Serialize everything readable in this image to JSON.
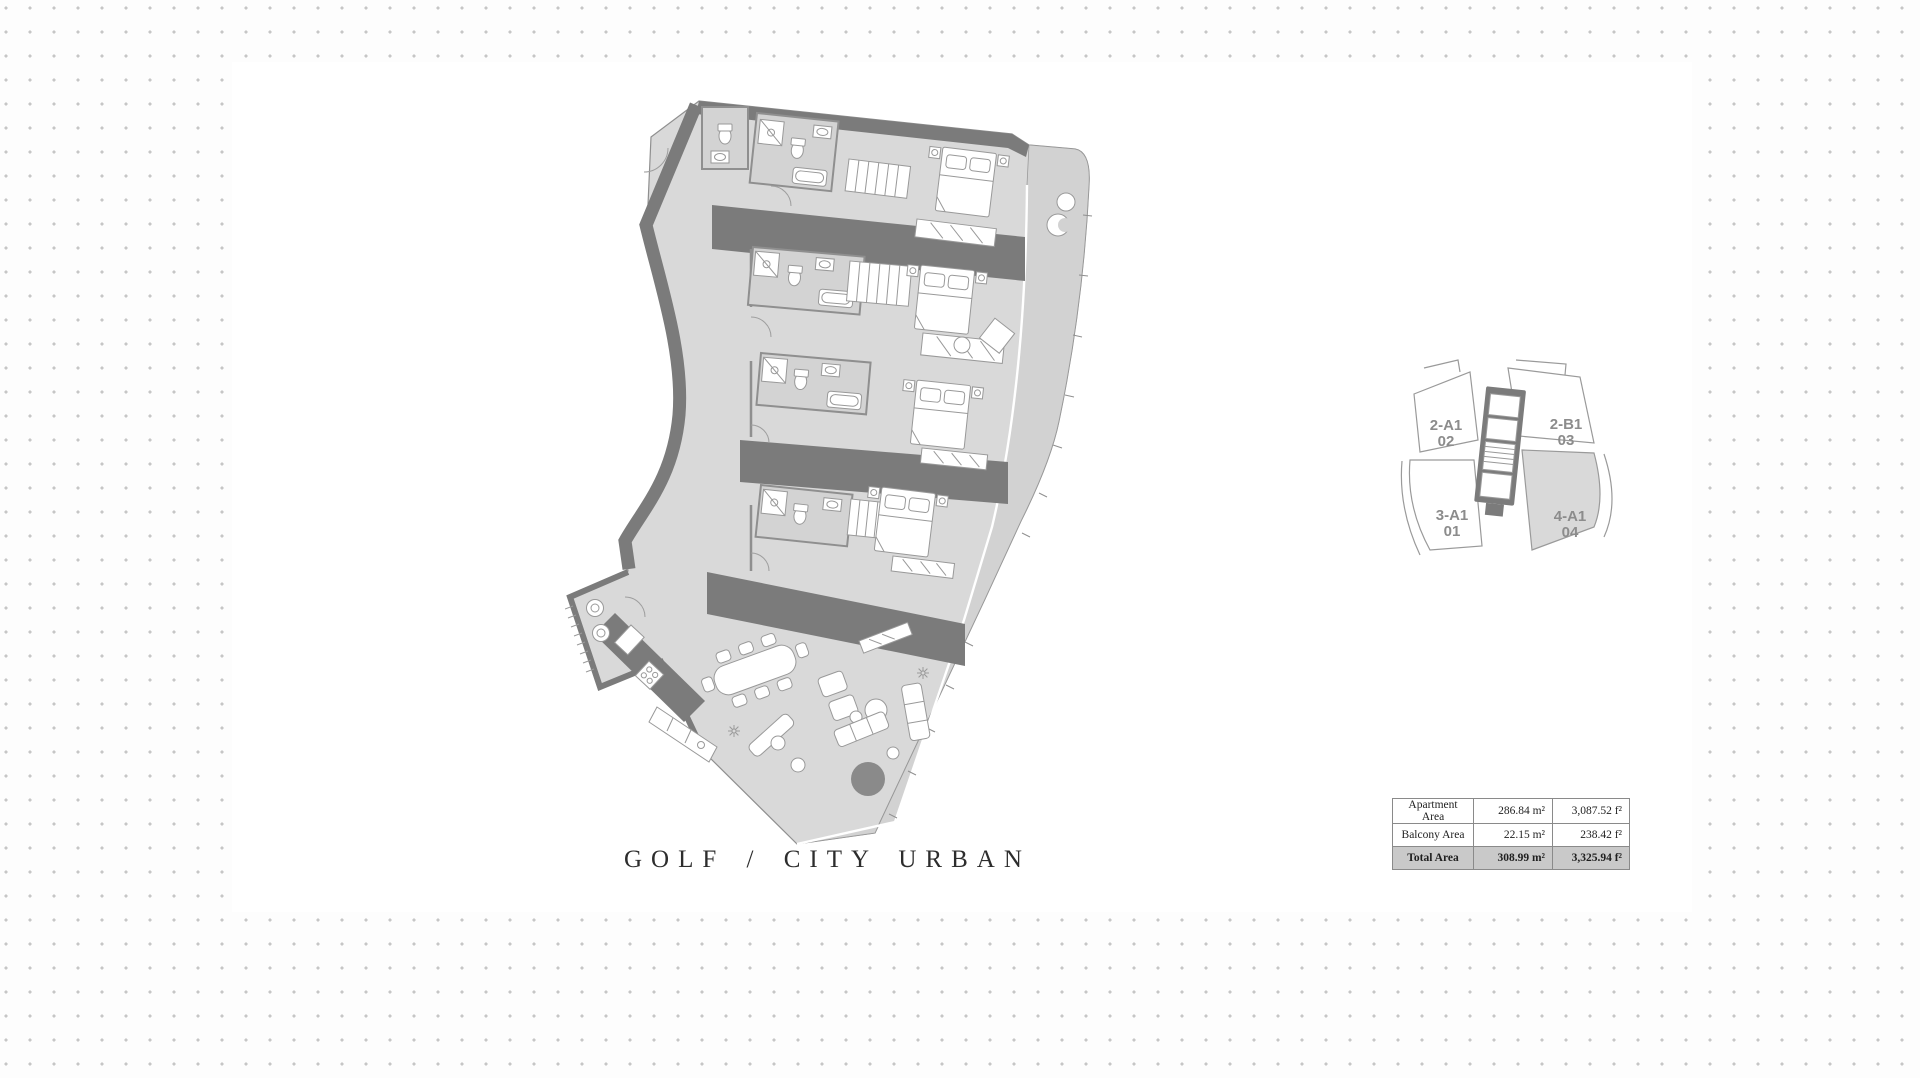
{
  "floor_plan": {
    "caption": "GOLF / CITY URBAN",
    "rooms": [
      "bedroom-1",
      "bedroom-2",
      "bedroom-3",
      "bedroom-4",
      "living-dining",
      "kitchen",
      "utility",
      "balcony"
    ]
  },
  "key_plan": {
    "units": [
      {
        "type": "2-A1",
        "number": "02",
        "highlighted": false
      },
      {
        "type": "2-B1",
        "number": "03",
        "highlighted": false
      },
      {
        "type": "3-A1",
        "number": "01",
        "highlighted": false
      },
      {
        "type": "4-A1",
        "number": "04",
        "highlighted": true
      }
    ],
    "highlight_color": "#d9d9d9"
  },
  "area_table": {
    "rows": [
      {
        "label": "Apartment Area",
        "metric": "286.84  m²",
        "imperial": "3,087.52  f²",
        "highlighted": false
      },
      {
        "label": "Balcony Area",
        "metric": "22.15  m²",
        "imperial": "238.42  f²",
        "highlighted": false
      },
      {
        "label": "Total Area",
        "metric": "308.99  m²",
        "imperial": "3,325.94  f²",
        "highlighted": true
      }
    ]
  },
  "colors": {
    "wall": "#7b7b7b",
    "floor": "#d9d9d9",
    "balcony": "#d2d2d2",
    "dot_grid": "#c6c6c6",
    "coffee_table": "#8a8a8a",
    "caption_text": "#2d2d2d"
  }
}
